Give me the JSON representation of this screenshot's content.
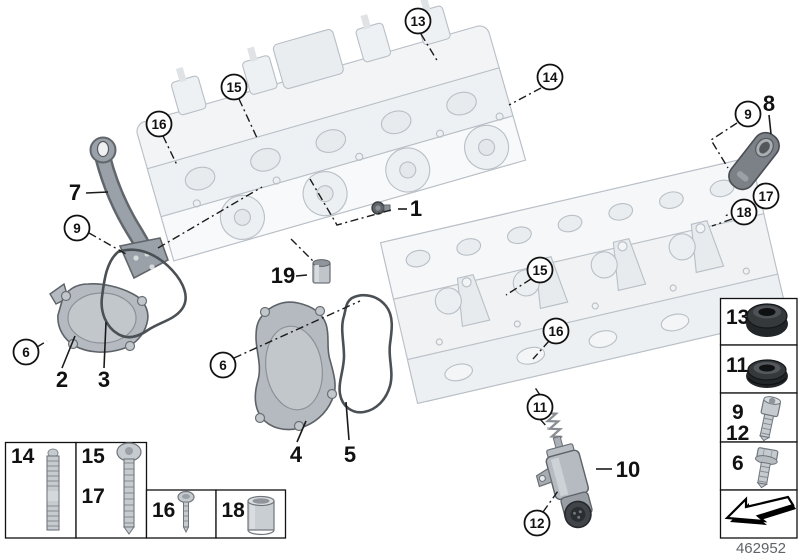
{
  "diagram_number": "462952",
  "circled_callouts": [
    {
      "label": "13"
    },
    {
      "label": "14"
    },
    {
      "label": "15"
    },
    {
      "label": "16"
    },
    {
      "label": "9"
    },
    {
      "label": "6"
    },
    {
      "label": "6"
    },
    {
      "label": "9"
    },
    {
      "label": "17"
    },
    {
      "label": "18"
    },
    {
      "label": "15"
    },
    {
      "label": "16"
    },
    {
      "label": "11"
    },
    {
      "label": "12"
    }
  ],
  "plain_labels": [
    {
      "label": "7"
    },
    {
      "label": "1"
    },
    {
      "label": "19"
    },
    {
      "label": "2"
    },
    {
      "label": "3"
    },
    {
      "label": "4"
    },
    {
      "label": "5"
    },
    {
      "label": "8"
    },
    {
      "label": "10"
    }
  ],
  "legend_left": {
    "cells": [
      {
        "labels": [
          "14"
        ],
        "icon": "stud-icon"
      },
      {
        "labels": [
          "15",
          "17"
        ],
        "icon": "long-torx-screw-icon"
      },
      {
        "labels": [
          "16"
        ],
        "icon": "small-screw-icon"
      },
      {
        "labels": [
          "18"
        ],
        "icon": "sleeve-icon"
      }
    ]
  },
  "legend_right": {
    "cells": [
      {
        "labels": [
          "13"
        ],
        "icon": "shaft-seal-icon"
      },
      {
        "labels": [
          "11"
        ],
        "icon": "profile-gasket-icon"
      },
      {
        "labels": [
          "9",
          "12"
        ],
        "icon": "socket-head-screw-icon"
      },
      {
        "labels": [
          "6"
        ],
        "icon": "hex-flange-bolt-icon"
      },
      {
        "labels": [],
        "icon": "direction-arrow-icon"
      }
    ]
  },
  "colors": {
    "background": "#ffffff",
    "line_black": "#1b1b1b",
    "ghost_fill": "#f2f4f6",
    "ghost_fill_light": "#f7f9fa",
    "ghost_detail": "#e7ebee",
    "ghost_stroke": "#b8bfc6",
    "part_gray": "#b4bac0",
    "part_gray_dark": "#7b8187",
    "part_outline": "#5d6268",
    "metal_light": "#c6cbd0",
    "metal_stroke": "#6f757c",
    "seal_black": "#26292b",
    "diagram_number_color": "#5f6468"
  }
}
